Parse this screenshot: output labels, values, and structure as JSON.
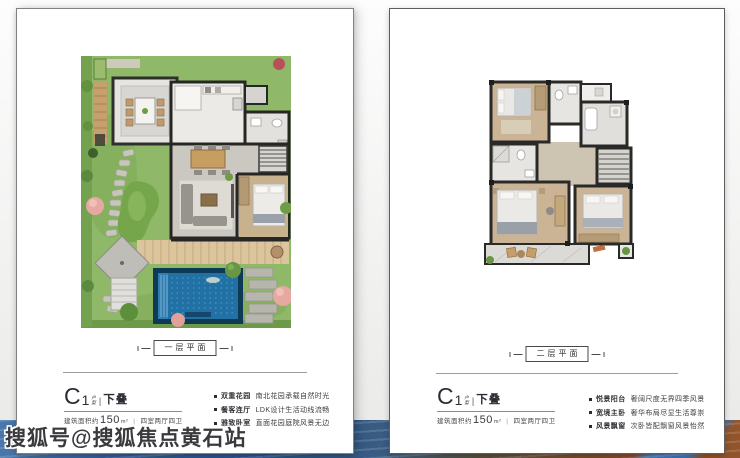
{
  "watermark": {
    "text": "搜狐号@搜狐焦点黄石站"
  },
  "colors": {
    "pool_blue": "#2171a4",
    "lawn_green": "#8fb968",
    "wall_dark": "#262624",
    "water_strip_blue": "#315e92",
    "water_strip_brown": "#8a4e2a"
  },
  "left_panel": {
    "plan_label": "一层平面",
    "unit": {
      "prefix": "C",
      "number": "1",
      "stack_top": "户",
      "stack_bottom": "型",
      "divider": "|",
      "suffix": "下叠"
    },
    "area": {
      "label_prefix": "建筑面积约",
      "value": "150",
      "unit": "m²",
      "separator": "|",
      "layout": "四室两厅四卫"
    },
    "features": [
      {
        "head": "双重花园",
        "desc": "南北花园承载自然时光"
      },
      {
        "head": "餐客连厅",
        "desc": "LDK设计生活动线流畅"
      },
      {
        "head": "雅致卧室",
        "desc": "直面花园庭院风景无边"
      }
    ]
  },
  "right_panel": {
    "plan_label": "二层平面",
    "unit": {
      "prefix": "C",
      "number": "1",
      "stack_top": "户",
      "stack_bottom": "型",
      "divider": "|",
      "suffix": "下叠"
    },
    "area": {
      "label_prefix": "建筑面积约",
      "value": "150",
      "unit": "m²",
      "separator": "|",
      "layout": "四室两厅四卫"
    },
    "features": [
      {
        "head": "悦景阳台",
        "desc": "奢阔尺度无界四季风景"
      },
      {
        "head": "宽境主卧",
        "desc": "奢华布局尽显生活尊崇"
      },
      {
        "head": "风景飘窗",
        "desc": "次卧皆配飘窗风景怡然"
      }
    ]
  }
}
